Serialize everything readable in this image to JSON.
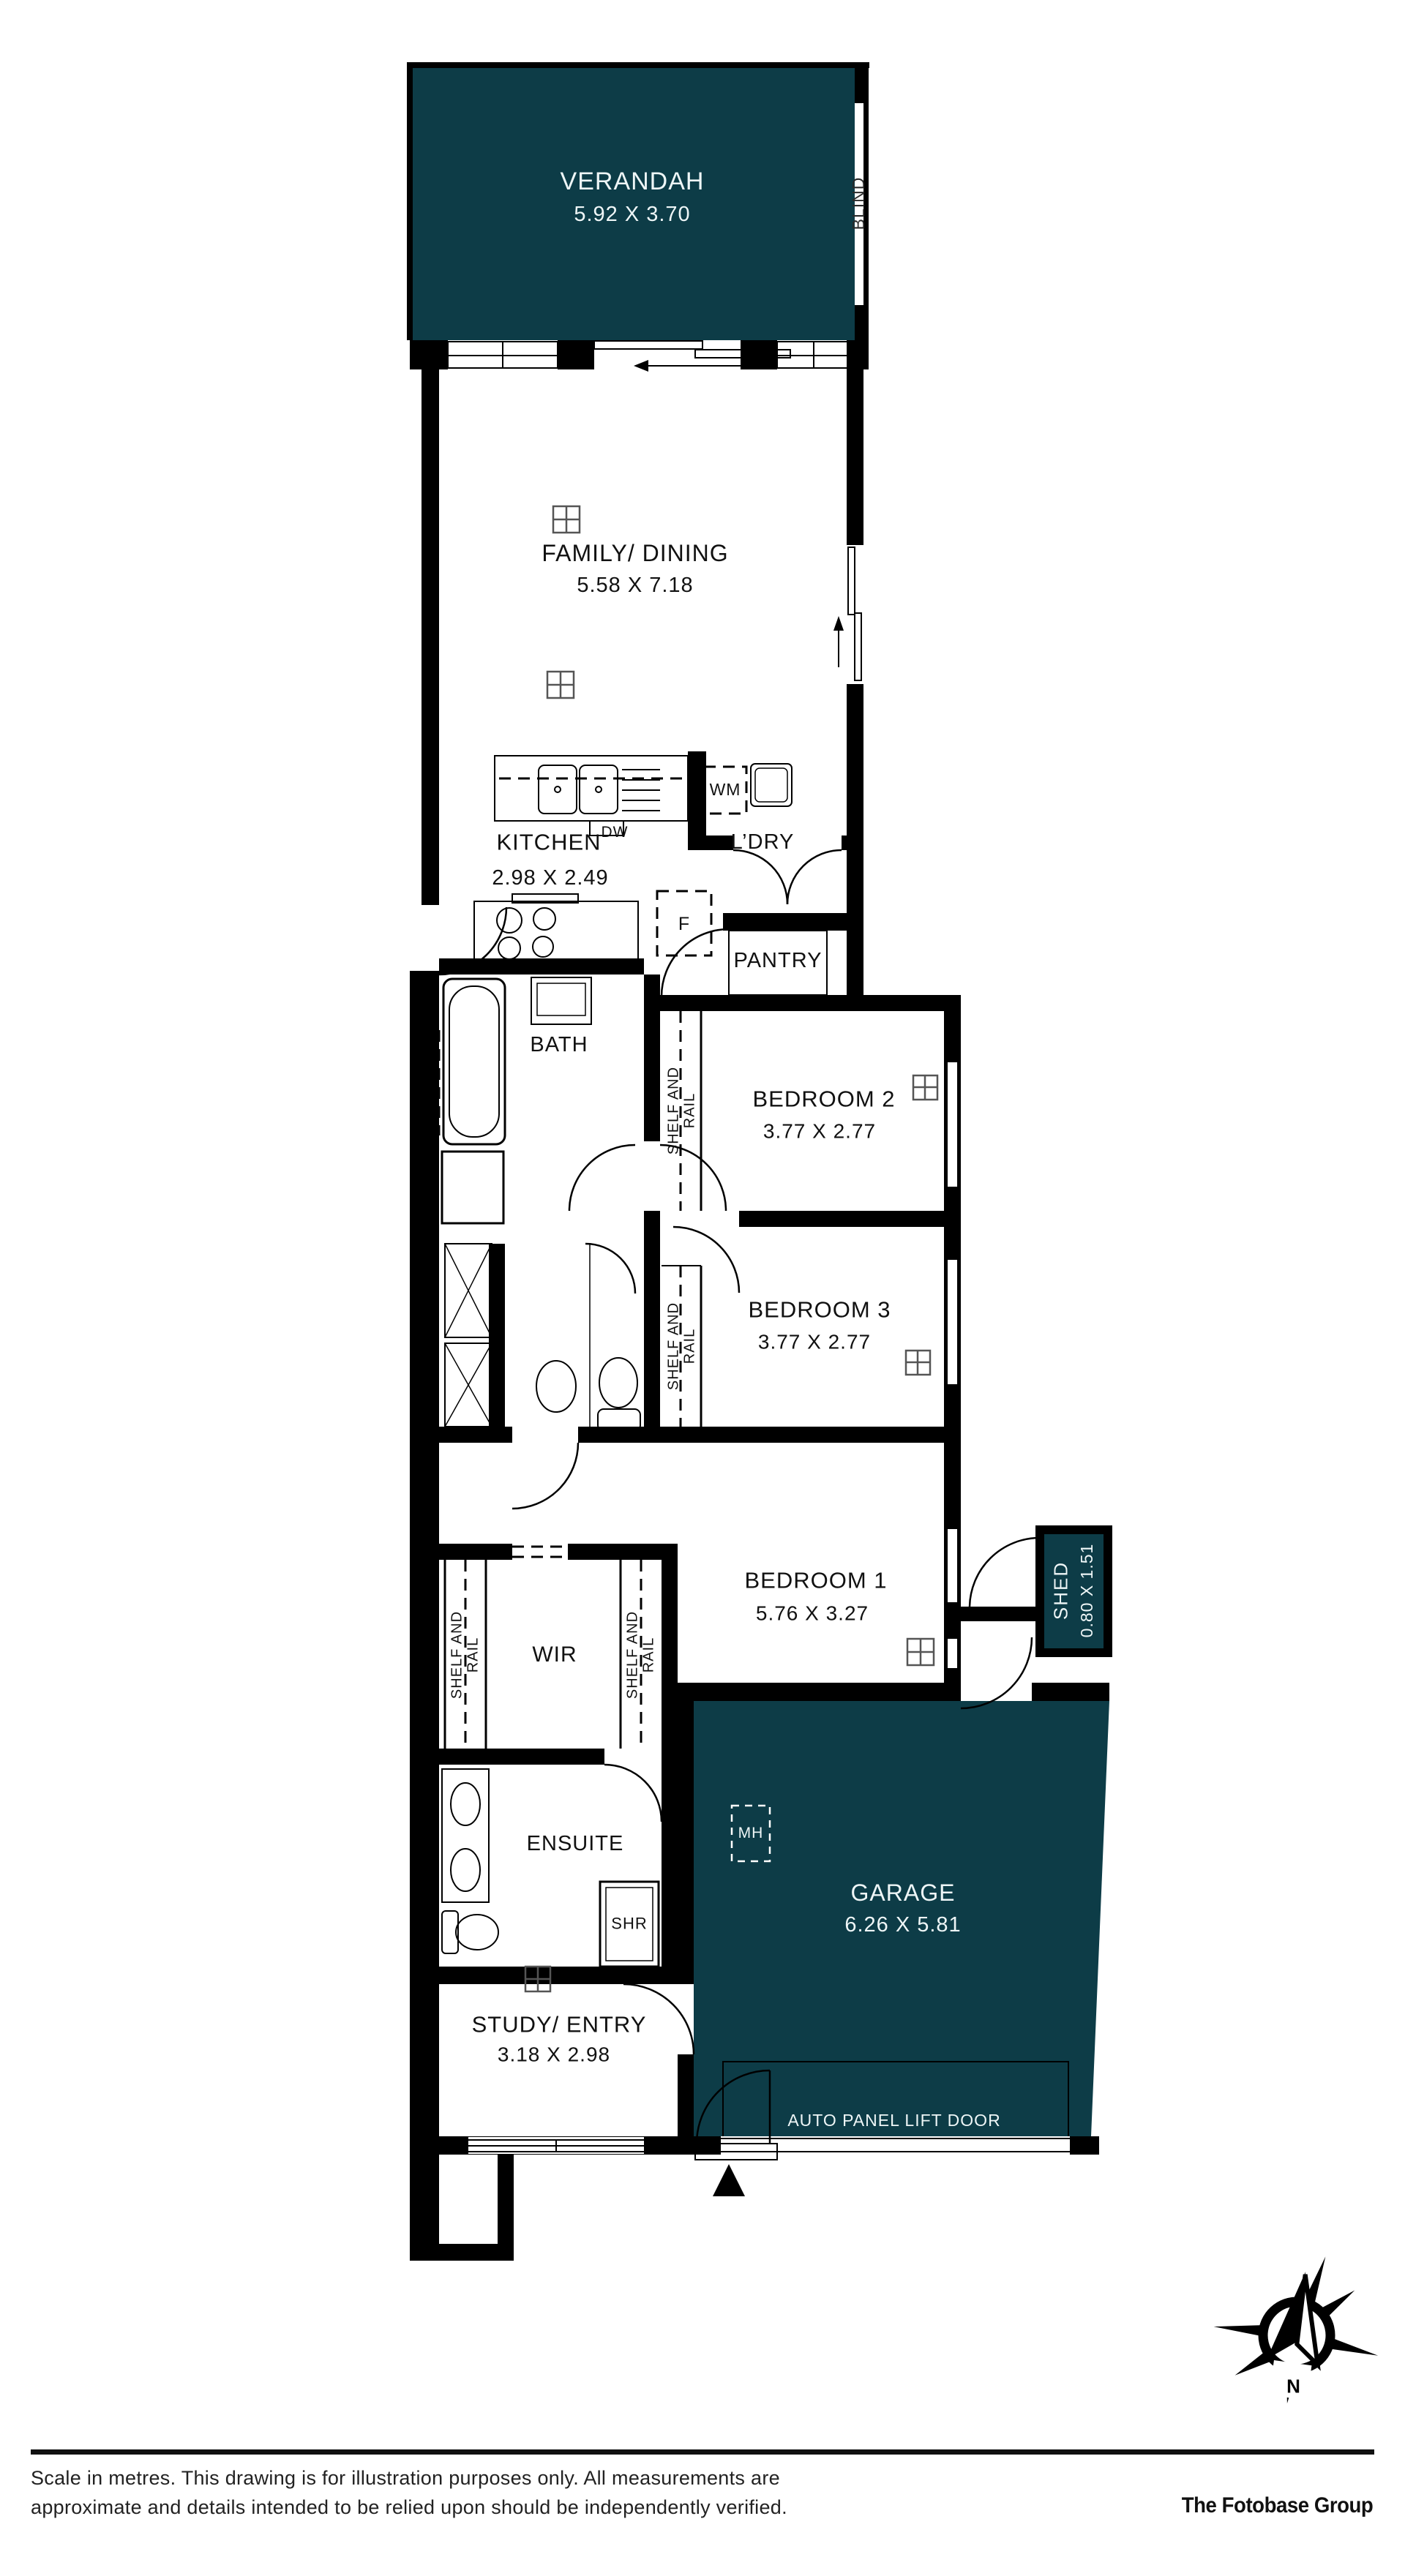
{
  "plan": {
    "rooms": {
      "verandah": {
        "label": "VERANDAH",
        "dims": "5.92 X 3.70"
      },
      "family": {
        "label": "FAMILY/ DINING",
        "dims": "5.58 X 7.18"
      },
      "kitchen": {
        "label": "KITCHEN",
        "dims": "2.98 X 2.49"
      },
      "ldry": {
        "label": "L’DRY"
      },
      "pantry": {
        "label": "PANTRY"
      },
      "bath": {
        "label": "BATH"
      },
      "bedroom2": {
        "label": "BEDROOM 2",
        "dims": "3.77 X 2.77"
      },
      "bedroom3": {
        "label": "BEDROOM 3",
        "dims": "3.77 X 2.77"
      },
      "bedroom1": {
        "label": "BEDROOM 1",
        "dims": "5.76 X 3.27"
      },
      "wir": {
        "label": "WIR"
      },
      "ensuite": {
        "label": "ENSUITE"
      },
      "shed": {
        "label": "SHED",
        "dims": "0.80 X 1.51"
      },
      "garage": {
        "label": "GARAGE",
        "dims": "6.26 X 5.81"
      },
      "study": {
        "label": "STUDY/ ENTRY",
        "dims": "3.18 X 2.98"
      }
    },
    "fixtures": {
      "wm": "WM",
      "dw": "DW",
      "fridge": "F",
      "shower": "SHR",
      "manhole": "MH",
      "blind": "BLIND",
      "shelf_and_rail": "SHELF AND RAIL",
      "garage_door": "AUTO PANEL LIFT DOOR"
    },
    "compass": {
      "north": "N"
    }
  },
  "footer": {
    "disclaimer_line1": "Scale in metres. This drawing is for illustration purposes only. All measurements are",
    "disclaimer_line2": "approximate and details intended to be relied upon should be independently verified.",
    "brand": "The Fotobase Group"
  },
  "colors": {
    "accent": "#0d3c47",
    "wall": "#000000",
    "background": "#ffffff"
  }
}
